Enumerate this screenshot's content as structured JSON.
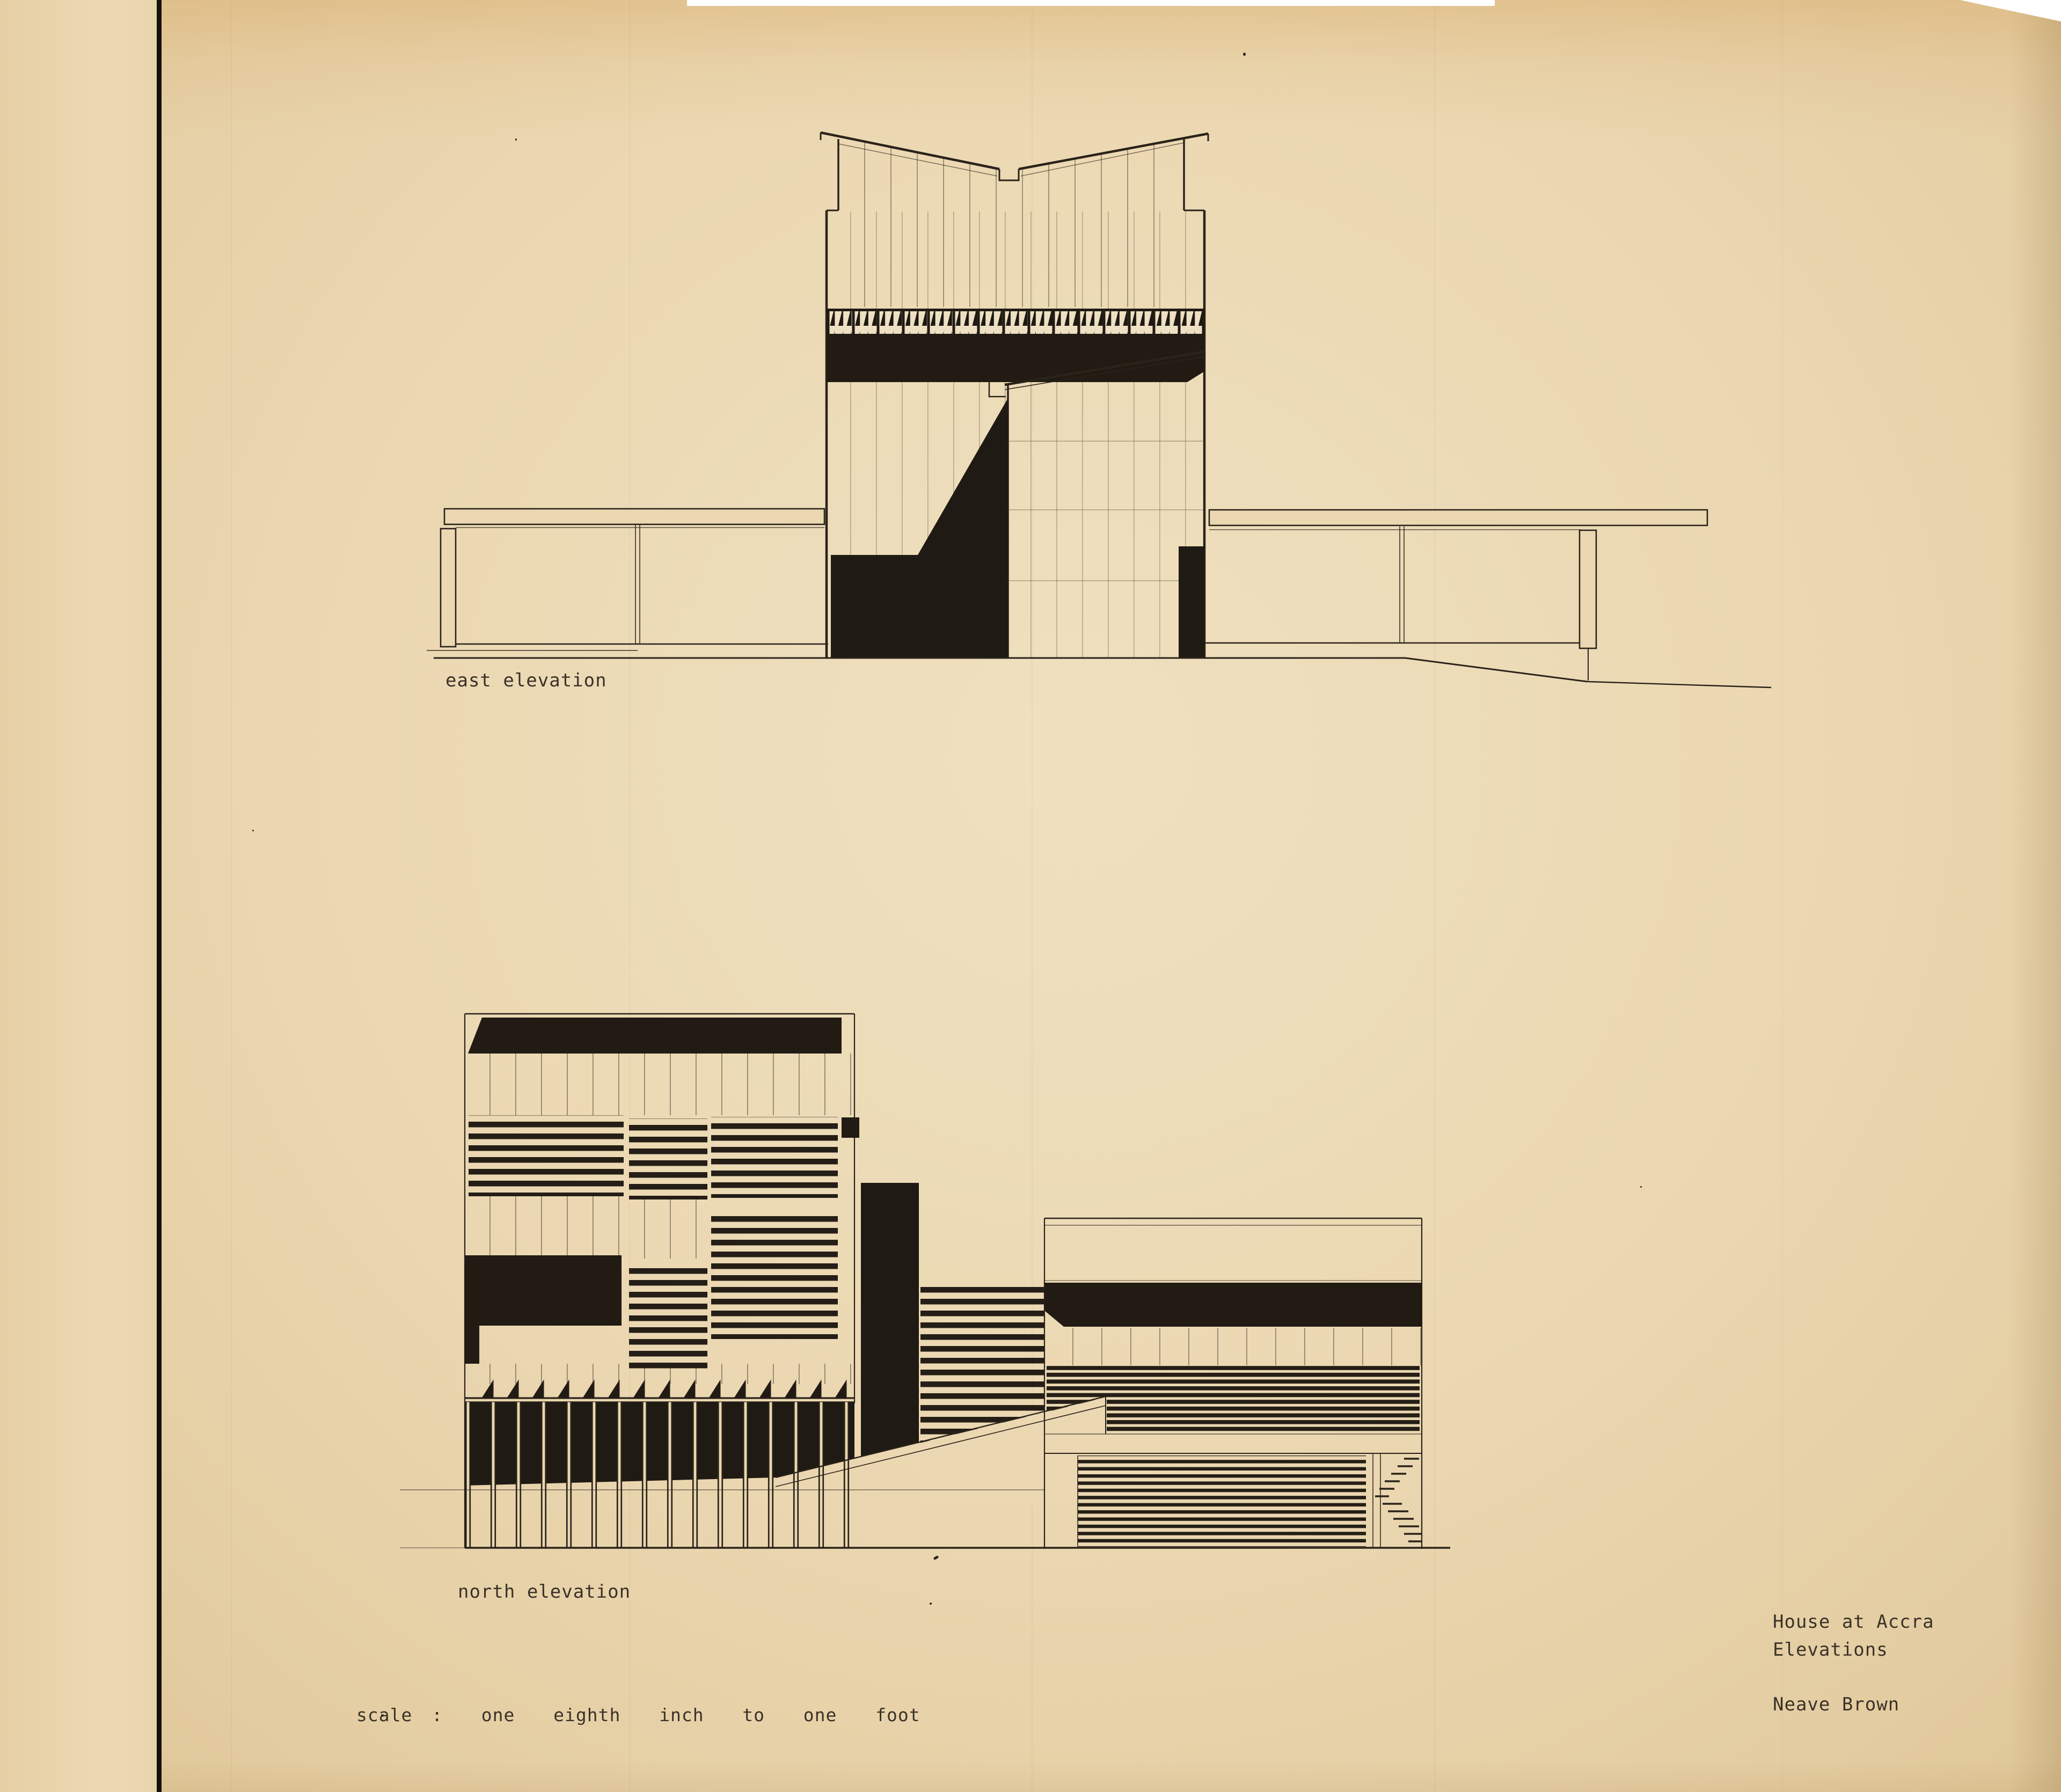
{
  "page": {
    "kind": "architectural elevation drawing sheet",
    "media": "typewritten labels on aged tracing paper"
  },
  "drawings": {
    "east": {
      "caption": "east elevation"
    },
    "north": {
      "caption": "north elevation"
    }
  },
  "scale_note": "scale :  one  eighth  inch  to  one  foot",
  "title_block": {
    "project": "House at Accra",
    "sheet": "Elevations",
    "architect": "Neave Brown"
  },
  "colors": {
    "paper": "#ebd8b2",
    "paper_light": "#efe0bf",
    "paper_edge": "#ddc595",
    "ink": "#2a231a",
    "black_fill": "#211b14",
    "binding_rule": "#17110b"
  }
}
